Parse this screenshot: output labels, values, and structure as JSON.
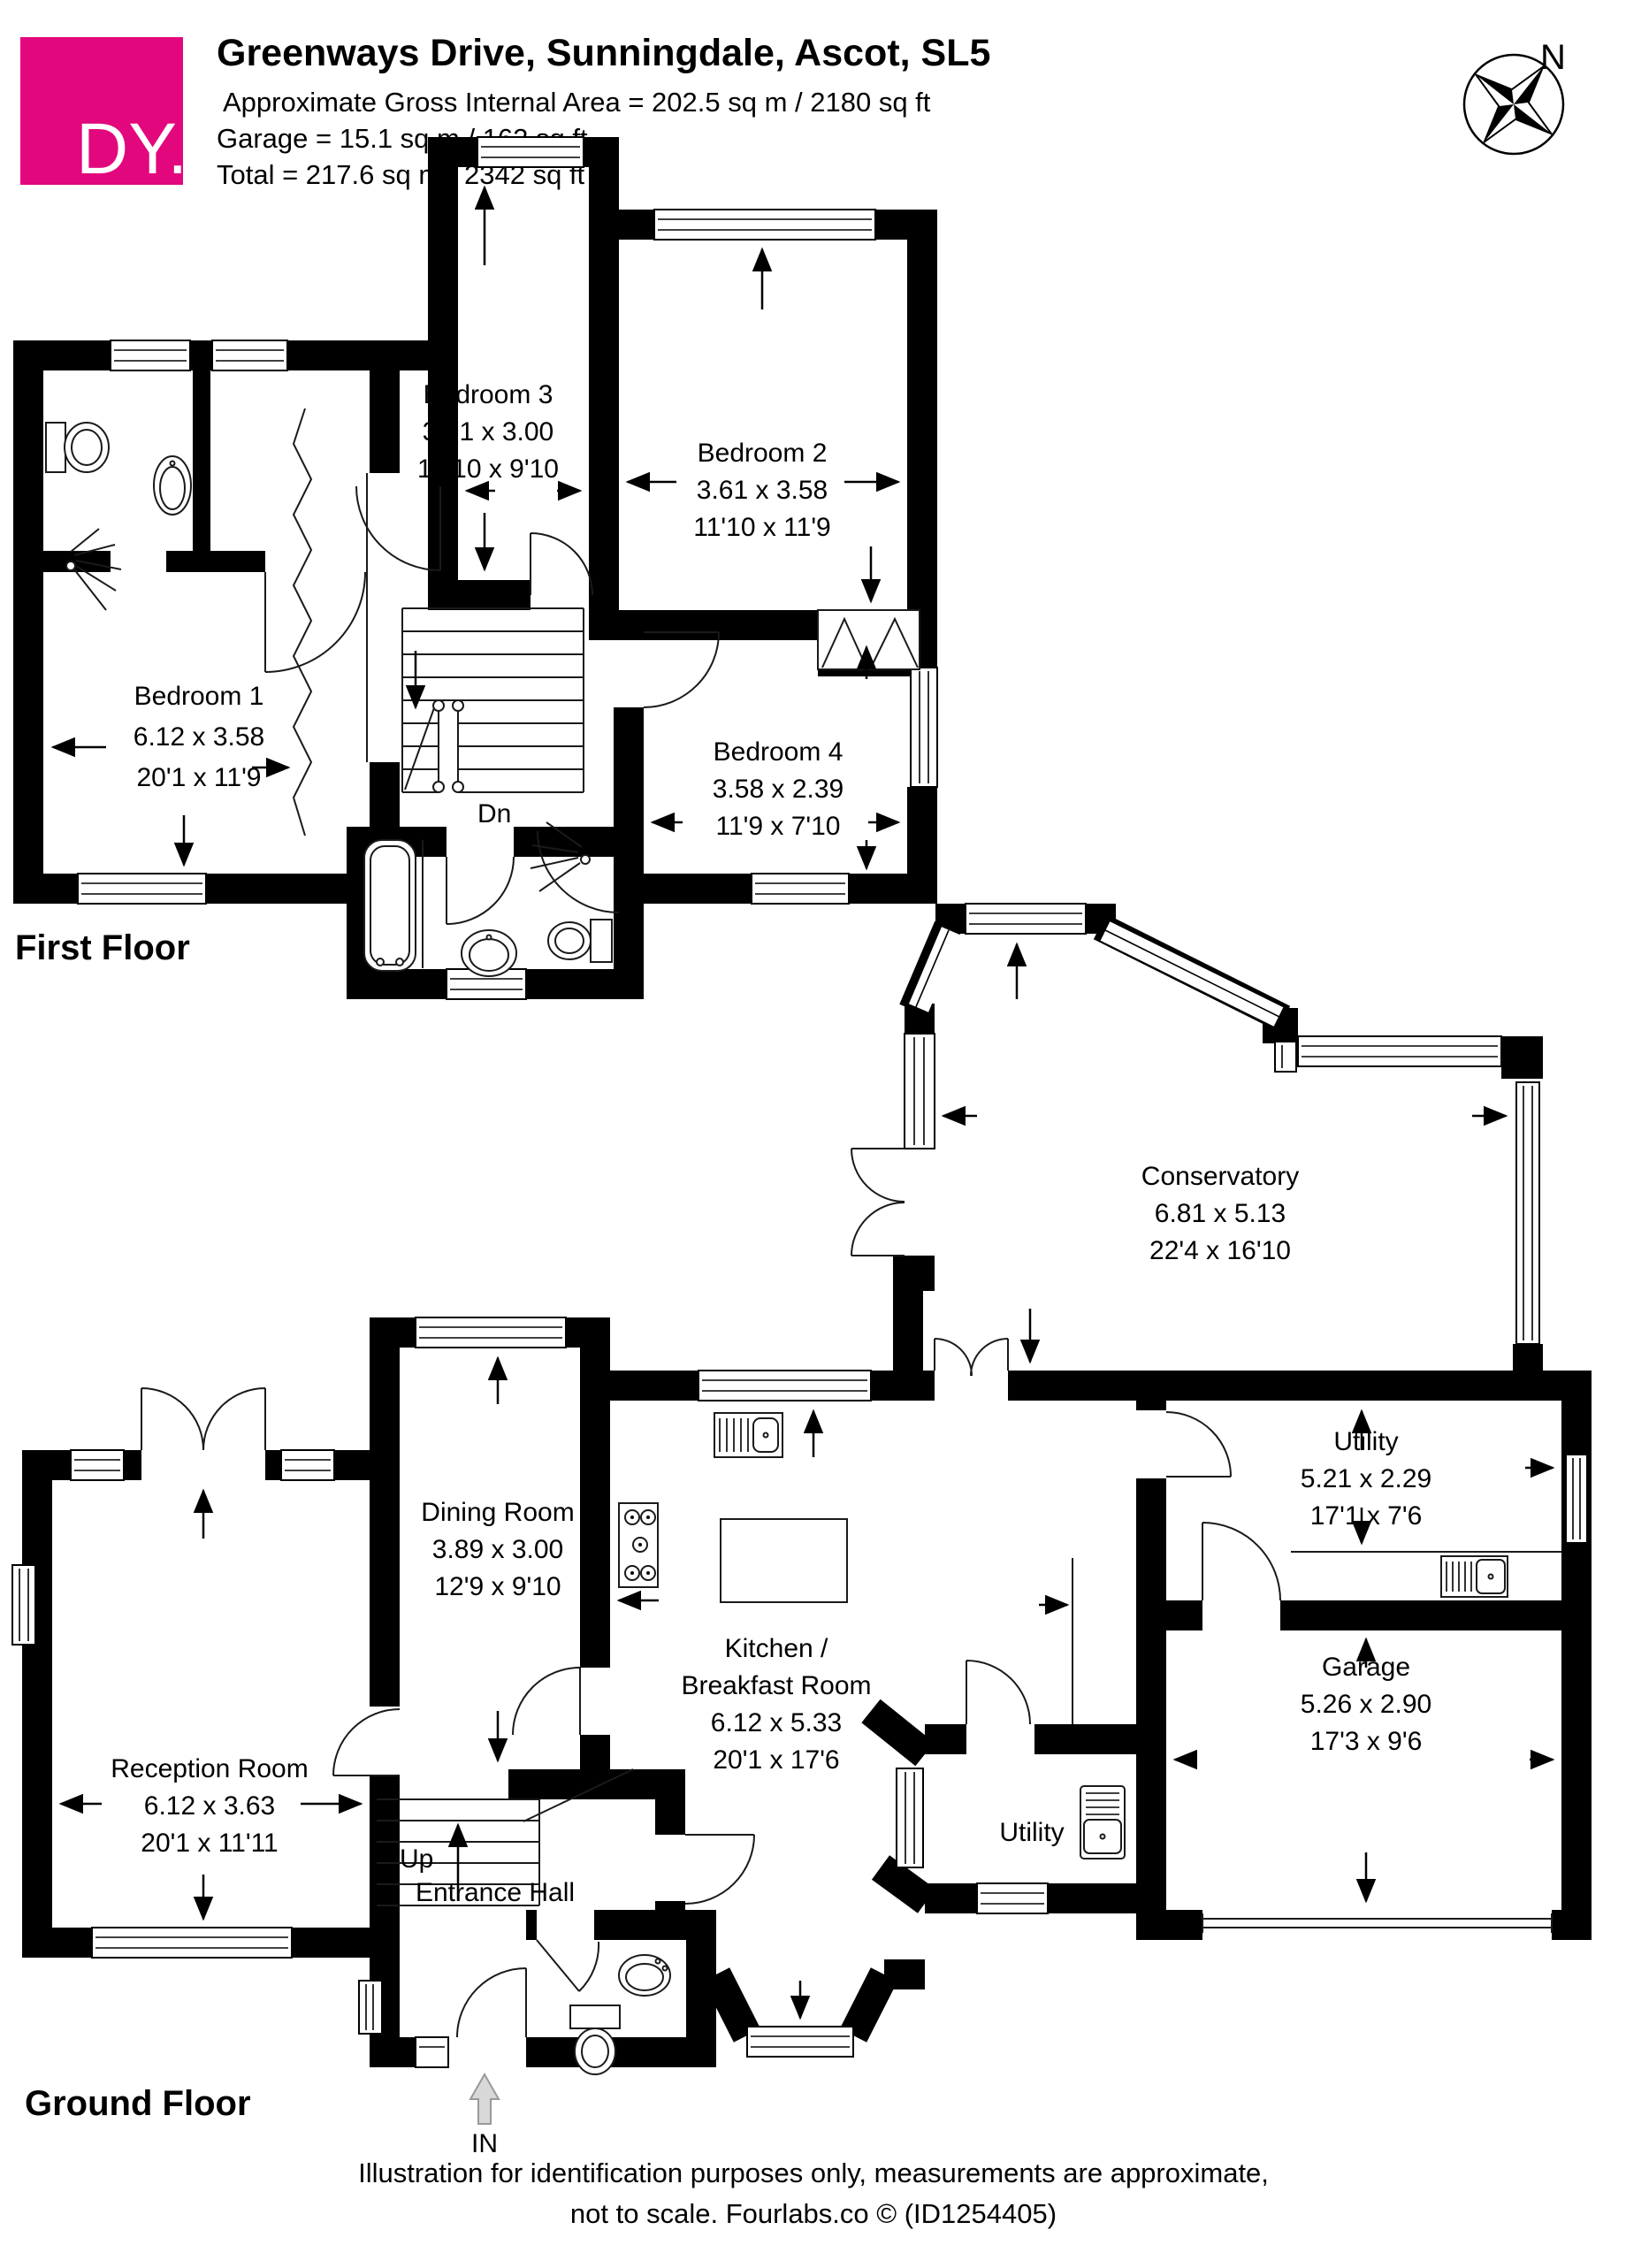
{
  "header": {
    "logo_text": "DY.",
    "title": "Greenways Drive, Sunningdale, Ascot, SL5",
    "area_line": "Approximate Gross Internal Area = 202.5 sq m / 2180 sq ft",
    "garage_line": "Garage = 15.1 sq m / 162 sq ft",
    "total_line": "Total = 217.6 sq m / 2342 sq ft",
    "accent_color": "#E2077C"
  },
  "compass": {
    "north_label": "N"
  },
  "first_floor": {
    "label": "First Floor",
    "stairs_label": "Dn",
    "rooms": {
      "bedroom1": {
        "name": "Bedroom 1",
        "metric": "6.12 x 3.58",
        "imperial": "20'1 x 11'9"
      },
      "bedroom2": {
        "name": "Bedroom 2",
        "metric": "3.61 x 3.58",
        "imperial": "11'10 x 11'9"
      },
      "bedroom3": {
        "name": "Bedroom 3",
        "metric": "3.91 x 3.00",
        "imperial": "12'10 x 9'10"
      },
      "bedroom4": {
        "name": "Bedroom 4",
        "metric": "3.58 x 2.39",
        "imperial": "11'9 x 7'10"
      }
    }
  },
  "ground_floor": {
    "label": "Ground Floor",
    "stairs_label": "Up",
    "entrance_label": "IN",
    "rooms": {
      "reception": {
        "name": "Reception Room",
        "metric": "6.12 x 3.63",
        "imperial": "20'1 x 11'11"
      },
      "dining": {
        "name": "Dining Room",
        "metric": "3.89 x 3.00",
        "imperial": "12'9 x 9'10"
      },
      "kitchen": {
        "name_line1": "Kitchen /",
        "name_line2": "Breakfast Room",
        "metric": "6.12 x 5.33",
        "imperial": "20'1 x 17'6"
      },
      "conservatory": {
        "name": "Conservatory",
        "metric": "6.81 x 5.13",
        "imperial": "22'4 x 16'10"
      },
      "utility": {
        "name": "Utility",
        "metric": "5.21 x 2.29",
        "imperial": "17'1 x 7'6"
      },
      "garage": {
        "name": "Garage",
        "metric": "5.26 x 2.90",
        "imperial": "17'3 x 9'6"
      },
      "utility_small": {
        "name": "Utility"
      },
      "entrance_hall": {
        "name": "Entrance Hall"
      }
    }
  },
  "footer": {
    "line1": "Illustration for identification purposes only, measurements are approximate,",
    "line2": "not to scale. Fourlabs.co © (ID1254405)"
  }
}
